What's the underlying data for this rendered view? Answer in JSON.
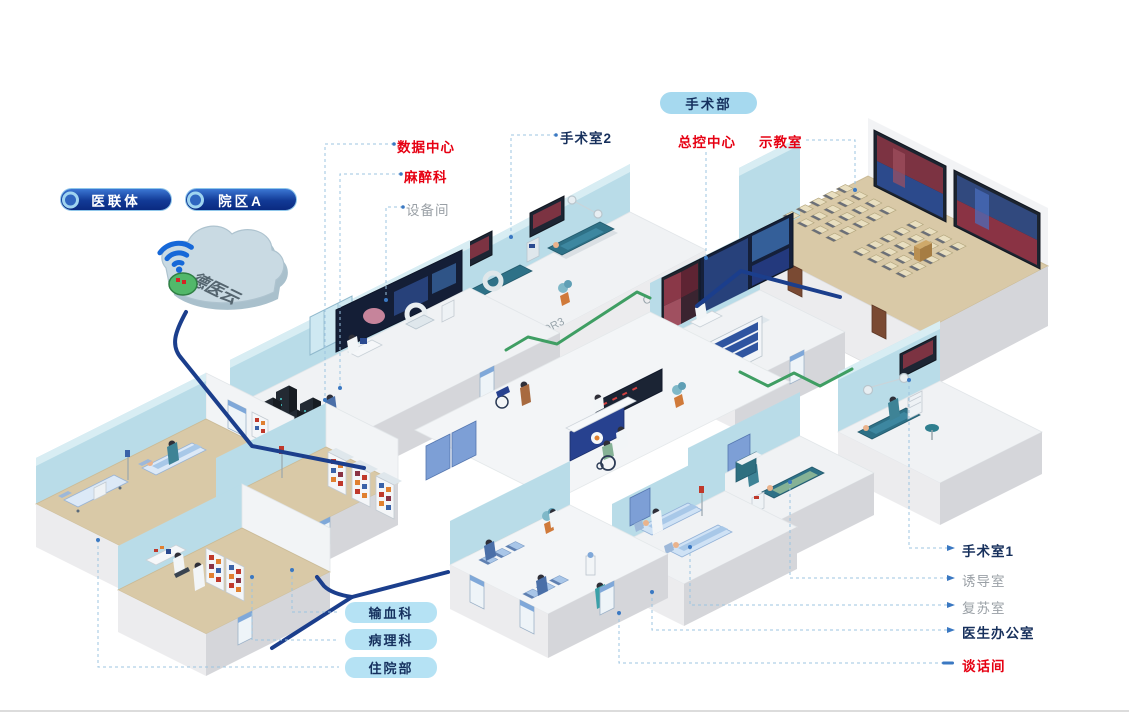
{
  "page": {
    "background": "#ffffff"
  },
  "header_badges": {
    "consortium": "医联体",
    "campus": "院区A",
    "department": "手术部"
  },
  "cloud_group": {
    "cloud_label": "德医云"
  },
  "callouts": {
    "data_center": "数据中心",
    "anesthesiology": "麻醉科",
    "equipment_room": "设备间",
    "operating_room_2": "手术室2",
    "master_control_center": "总控中心",
    "demo_classroom": "示教室",
    "operating_room_1": "手术室1",
    "induction_room": "诱导室",
    "recovery_room": "复苏室",
    "doctor_office": "医生办公室",
    "conversation_room": "谈话间"
  },
  "room_pills": {
    "blood_transfusion": "输血科",
    "pathology": "病理科",
    "inpatient_department": "住院部"
  },
  "wall_marks": {
    "or2": "OR2",
    "or3": "OR3"
  },
  "colors": {
    "callout_red": "#e60012",
    "callout_gray": "#9aa0a6",
    "callout_dark": "#17305c",
    "pill_badge_bg": "#a6d9ef",
    "room_pill_bg": "#b5e2f4",
    "nav_pill_bg": "#0a2a80",
    "cable_navy": "#1b3e8c",
    "cable_green": "#3f9e63",
    "connector_blue": "#9cc4e0",
    "wall_blue": "#b9dce8",
    "floor_tan": "#d9c9a7",
    "floor_white": "#f0f2f4"
  },
  "scene": {
    "classroom_seats": {
      "rows": 4,
      "cols": 5,
      "blocks": [
        {
          "x": 783,
          "y": 216
        },
        {
          "x": 853,
          "y": 252
        }
      ]
    },
    "waiting_chairs": {
      "rows": 1,
      "cols": 3,
      "blocks": [
        {
          "x": 479,
          "y": 560
        },
        {
          "x": 523,
          "y": 594
        }
      ]
    }
  }
}
